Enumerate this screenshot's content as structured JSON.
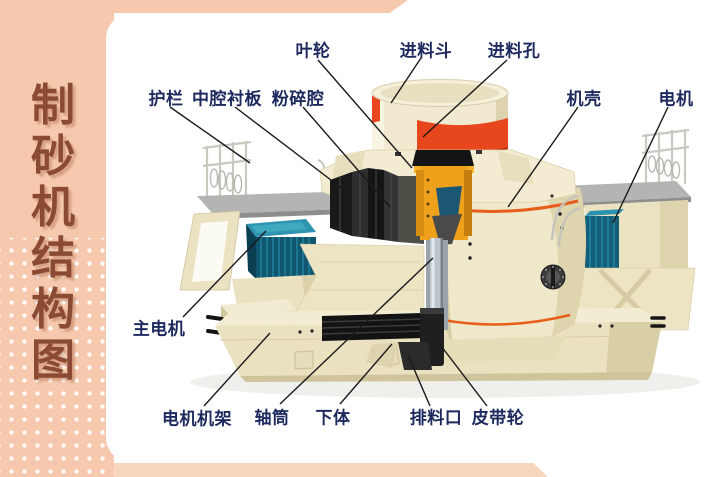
{
  "sidebar": {
    "title": "制砂机结构图",
    "title_chars": [
      "制",
      "砂",
      "机",
      "结",
      "构",
      "图"
    ],
    "bg_color": "#f6c9ae",
    "title_color": "#8a4a33"
  },
  "ribbons": {
    "top_color": "#f6c9ae",
    "bottom_color": "#f8d5bd"
  },
  "diagram": {
    "label_color": "#1e2a5e",
    "leader_line_color": "#1a1a1a",
    "machine_colors": {
      "body_cream": "#ece4c3",
      "hopper_red": "#e8461c",
      "trim_orange": "#e95d1b",
      "impeller_orange": "#f0a11c",
      "motor_teal": "#10566f",
      "platform_gray": "#b4b4b2",
      "internals_black": "#191919",
      "shaft_silver": "#bcc5cb"
    },
    "labels": [
      {
        "id": "impeller",
        "text": "叶轮"
      },
      {
        "id": "feed-hopper",
        "text": "进料斗"
      },
      {
        "id": "feed-inlet-hole",
        "text": "进料孔"
      },
      {
        "id": "guardrail",
        "text": "护栏"
      },
      {
        "id": "middle-cavity-liner",
        "text": "中腔衬板"
      },
      {
        "id": "crushing-chamber",
        "text": "粉碎腔"
      },
      {
        "id": "casing",
        "text": "机壳"
      },
      {
        "id": "motor",
        "text": "电机"
      },
      {
        "id": "main-motor",
        "text": "主电机"
      },
      {
        "id": "motor-frame",
        "text": "电机机架"
      },
      {
        "id": "shaft-tube",
        "text": "轴筒"
      },
      {
        "id": "lower-body",
        "text": "下体"
      },
      {
        "id": "discharge-port",
        "text": "排料口"
      },
      {
        "id": "belt-pulley",
        "text": "皮带轮"
      }
    ]
  }
}
